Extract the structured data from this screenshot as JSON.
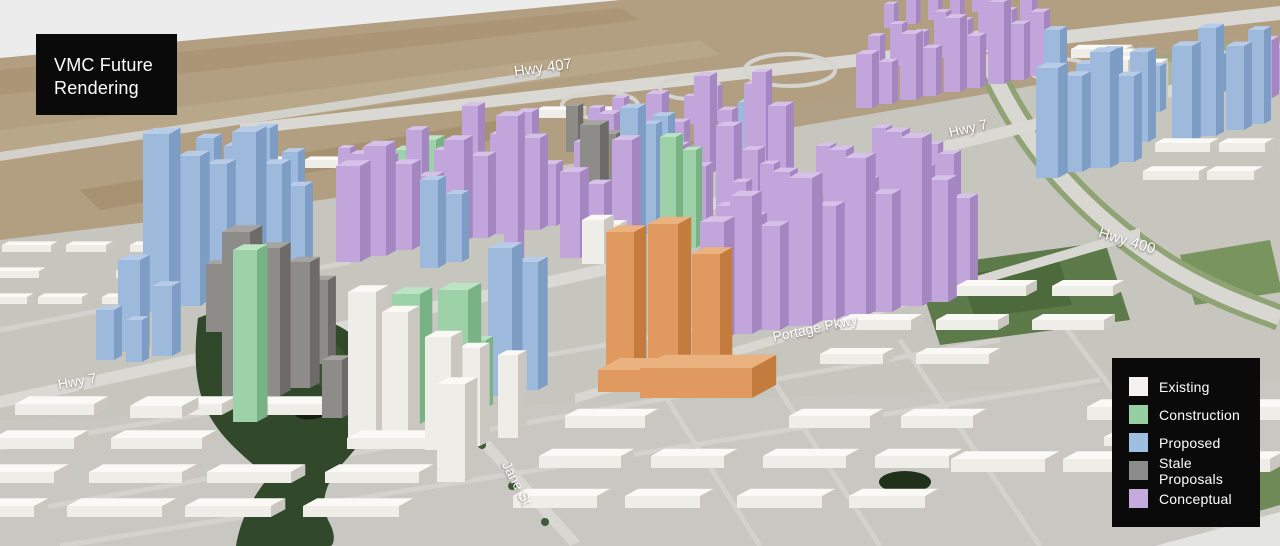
{
  "title": {
    "line1": "VMC Future",
    "line2": "Rendering"
  },
  "legend": {
    "items": [
      {
        "key": "existing",
        "label": "Existing",
        "color": "#f3f2ee"
      },
      {
        "key": "construction",
        "label": "Construction",
        "color": "#96cfa2"
      },
      {
        "key": "proposed",
        "label": "Proposed",
        "color": "#9fbfe0"
      },
      {
        "key": "stale",
        "label": "Stale Proposals",
        "color": "#8c8c8c"
      },
      {
        "key": "conceptual",
        "label": "Conceptual",
        "color": "#c5aade"
      }
    ]
  },
  "map_labels": [
    {
      "id": "hwy-407",
      "text": "Hwy 407",
      "x": 543,
      "y": 68,
      "rot": -8,
      "size": 15
    },
    {
      "id": "hwy-7-east",
      "text": "Hwy 7",
      "x": 968,
      "y": 128,
      "rot": -13,
      "size": 14
    },
    {
      "id": "hwy-400",
      "text": "Hwy 400",
      "x": 1127,
      "y": 241,
      "rot": 17,
      "size": 15
    },
    {
      "id": "portage-pkwy",
      "text": "Portage Pkwy",
      "x": 815,
      "y": 328,
      "rot": -12,
      "size": 14
    },
    {
      "id": "hwy-7-west",
      "text": "Hwy 7",
      "x": 77,
      "y": 381,
      "rot": -10,
      "size": 14
    },
    {
      "id": "jane-st",
      "text": "Jane St",
      "x": 517,
      "y": 483,
      "rot": 62,
      "size": 14
    }
  ],
  "palette": {
    "existing": {
      "face": "#efede8",
      "side": "#c9c7c0",
      "roof": "#faf9f6"
    },
    "construction": {
      "face": "#9dd1a7",
      "side": "#79b385",
      "roof": "#bce3c3"
    },
    "proposed": {
      "face": "#9db9dc",
      "side": "#7d9dc4",
      "roof": "#b8cce8"
    },
    "stale": {
      "face": "#8e8c88",
      "side": "#6d6b67",
      "roof": "#a6a4a0"
    },
    "conceptual": {
      "face": "#c2a5da",
      "side": "#a486c1",
      "roof": "#d6c2e8"
    },
    "orange": {
      "face": "#e09a60",
      "side": "#c47c3e",
      "roof": "#eab27e"
    }
  },
  "scene": {
    "buildings": {
      "conceptual": [
        [
          336,
          262,
          24,
          96
        ],
        [
          364,
          256,
          22,
          110
        ],
        [
          392,
          250,
          20,
          86
        ],
        [
          418,
          246,
          18,
          70
        ],
        [
          444,
          242,
          20,
          102
        ],
        [
          470,
          238,
          18,
          82
        ],
        [
          496,
          234,
          20,
          118
        ],
        [
          522,
          230,
          18,
          92
        ],
        [
          504,
          262,
          14,
          146
        ],
        [
          350,
          212,
          16,
          58
        ],
        [
          378,
          206,
          14,
          50
        ],
        [
          406,
          200,
          16,
          70
        ],
        [
          434,
          196,
          14,
          46
        ],
        [
          462,
          192,
          16,
          86
        ],
        [
          490,
          188,
          14,
          54
        ],
        [
          516,
          184,
          16,
          72
        ],
        [
          540,
          226,
          16,
          62
        ],
        [
          338,
          182,
          12,
          34
        ],
        [
          362,
          176,
          12,
          28
        ],
        [
          560,
          258,
          20,
          86
        ],
        [
          586,
          252,
          18,
          68
        ],
        [
          612,
          248,
          20,
          108
        ],
        [
          664,
          240,
          18,
          94
        ],
        [
          690,
          236,
          16,
          70
        ],
        [
          716,
          232,
          18,
          106
        ],
        [
          742,
          228,
          16,
          78
        ],
        [
          768,
          224,
          18,
          118
        ],
        [
          574,
          196,
          14,
          54
        ],
        [
          598,
          190,
          16,
          76
        ],
        [
          646,
          182,
          16,
          88
        ],
        [
          670,
          178,
          14,
          56
        ],
        [
          694,
          174,
          16,
          98
        ],
        [
          718,
          170,
          14,
          60
        ],
        [
          744,
          166,
          14,
          82
        ],
        [
          766,
          162,
          12,
          46
        ],
        [
          588,
          140,
          12,
          32
        ],
        [
          612,
          136,
          12,
          38
        ],
        [
          636,
          132,
          10,
          26
        ],
        [
          684,
          124,
          10,
          28
        ],
        [
          708,
          120,
          10,
          34
        ],
        [
          752,
          204,
          14,
          132
        ],
        [
          700,
          340,
          24,
          118
        ],
        [
          730,
          334,
          22,
          138
        ],
        [
          760,
          330,
          20,
          104
        ],
        [
          788,
          326,
          24,
          148
        ],
        [
          816,
          320,
          20,
          114
        ],
        [
          844,
          316,
          22,
          158
        ],
        [
          872,
          312,
          20,
          118
        ],
        [
          900,
          306,
          22,
          168
        ],
        [
          928,
          302,
          20,
          122
        ],
        [
          952,
          296,
          18,
          98
        ],
        [
          716,
          290,
          18,
          84
        ],
        [
          744,
          284,
          16,
          68
        ],
        [
          772,
          280,
          18,
          108
        ],
        [
          800,
          276,
          16,
          78
        ],
        [
          828,
          272,
          18,
          122
        ],
        [
          856,
          268,
          16,
          88
        ],
        [
          884,
          264,
          18,
          132
        ],
        [
          912,
          260,
          16,
          92
        ],
        [
          938,
          256,
          16,
          102
        ],
        [
          732,
          240,
          14,
          58
        ],
        [
          760,
          236,
          14,
          72
        ],
        [
          788,
          232,
          14,
          54
        ],
        [
          816,
          228,
          14,
          82
        ],
        [
          844,
          224,
          12,
          58
        ],
        [
          872,
          220,
          14,
          92
        ],
        [
          900,
          216,
          12,
          62
        ],
        [
          926,
          212,
          12,
          68
        ],
        [
          856,
          108,
          16,
          54
        ],
        [
          878,
          104,
          14,
          42
        ],
        [
          900,
          100,
          16,
          66
        ],
        [
          922,
          96,
          14,
          48
        ],
        [
          944,
          92,
          16,
          74
        ],
        [
          966,
          88,
          14,
          52
        ],
        [
          988,
          84,
          16,
          82
        ],
        [
          1010,
          80,
          14,
          56
        ],
        [
          1030,
          76,
          14,
          64
        ],
        [
          868,
          70,
          12,
          34
        ],
        [
          890,
          66,
          12,
          42
        ],
        [
          912,
          62,
          12,
          30
        ],
        [
          934,
          58,
          12,
          46
        ],
        [
          956,
          54,
          12,
          34
        ],
        [
          978,
          50,
          12,
          50
        ],
        [
          1000,
          46,
          12,
          36
        ],
        [
          1020,
          42,
          12,
          42
        ],
        [
          884,
          28,
          10,
          24
        ],
        [
          906,
          24,
          10,
          30
        ],
        [
          928,
          20,
          10,
          20
        ],
        [
          950,
          16,
          10,
          26
        ],
        [
          972,
          12,
          10,
          22
        ],
        [
          1256,
          98,
          16,
          58
        ],
        [
          1272,
          90,
          10,
          42
        ]
      ],
      "proposed": [
        [
          196,
          246,
          18,
          108
        ],
        [
          224,
          242,
          16,
          96
        ],
        [
          252,
          240,
          18,
          112
        ],
        [
          282,
          238,
          16,
          86
        ],
        [
          143,
          312,
          26,
          178
        ],
        [
          178,
          306,
          22,
          150
        ],
        [
          207,
          302,
          20,
          138
        ],
        [
          232,
          298,
          24,
          166
        ],
        [
          262,
          292,
          20,
          128
        ],
        [
          287,
          286,
          18,
          100
        ],
        [
          118,
          352,
          22,
          92
        ],
        [
          152,
          356,
          20,
          70
        ],
        [
          96,
          360,
          18,
          50
        ],
        [
          126,
          362,
          16,
          42
        ],
        [
          420,
          268,
          18,
          88
        ],
        [
          446,
          262,
          16,
          68
        ],
        [
          488,
          396,
          24,
          148
        ],
        [
          516,
          390,
          22,
          128
        ],
        [
          620,
          240,
          18,
          132
        ],
        [
          642,
          234,
          14,
          110
        ],
        [
          652,
          186,
          16,
          70
        ],
        [
          738,
          158,
          14,
          56
        ],
        [
          1036,
          178,
          22,
          110
        ],
        [
          1062,
          172,
          20,
          96
        ],
        [
          1090,
          168,
          20,
          116
        ],
        [
          1116,
          162,
          18,
          86
        ],
        [
          1076,
          122,
          16,
          58
        ],
        [
          1100,
          118,
          16,
          68
        ],
        [
          1130,
          142,
          18,
          90
        ],
        [
          1146,
          112,
          14,
          46
        ],
        [
          1052,
          122,
          14,
          42
        ],
        [
          1044,
          94,
          16,
          64
        ],
        [
          1172,
          142,
          20,
          96
        ],
        [
          1198,
          136,
          18,
          108
        ],
        [
          1226,
          130,
          18,
          84
        ],
        [
          1248,
          124,
          16,
          94
        ],
        [
          1210,
          92,
          14,
          38
        ],
        [
          1240,
          88,
          14,
          34
        ]
      ],
      "construction": [
        [
          233,
          422,
          24,
          172
        ],
        [
          392,
          424,
          28,
          130
        ],
        [
          438,
          416,
          30,
          126
        ],
        [
          470,
          408,
          16,
          68
        ],
        [
          660,
          255,
          16,
          118
        ],
        [
          682,
          248,
          14,
          98
        ],
        [
          372,
          196,
          20,
          30
        ],
        [
          394,
          190,
          18,
          40
        ],
        [
          416,
          186,
          20,
          46
        ],
        [
          438,
          182,
          16,
          30
        ],
        [
          404,
          206,
          22,
          18
        ],
        [
          428,
          202,
          16,
          16
        ],
        [
          452,
          198,
          14,
          22
        ]
      ],
      "stale": [
        [
          222,
          402,
          28,
          170
        ],
        [
          256,
          396,
          24,
          148
        ],
        [
          288,
          388,
          22,
          126
        ],
        [
          310,
          364,
          18,
          84
        ],
        [
          206,
          332,
          16,
          68
        ],
        [
          322,
          418,
          20,
          58
        ],
        [
          580,
          230,
          20,
          105
        ],
        [
          600,
          222,
          16,
          88
        ],
        [
          566,
          152,
          12,
          46
        ]
      ],
      "existing": [
        [
          348,
          440,
          28,
          148
        ],
        [
          382,
          445,
          26,
          133
        ],
        [
          425,
          450,
          26,
          113
        ],
        [
          458,
          446,
          22,
          98
        ],
        [
          498,
          438,
          20,
          83
        ],
        [
          437,
          482,
          28,
          98
        ],
        [
          582,
          264,
          22,
          44
        ],
        [
          604,
          260,
          16,
          36
        ],
        [
          1092,
          118,
          18,
          58
        ],
        [
          1112,
          114,
          16,
          54
        ],
        [
          1132,
          110,
          16,
          50
        ],
        [
          1148,
          106,
          14,
          44
        ],
        [
          1120,
          86,
          14,
          34
        ],
        [
          1100,
          82,
          12,
          28
        ],
        [
          130,
          418,
          52,
          12,
          30
        ]
      ],
      "orange": [
        [
          606,
          378,
          28,
          146
        ],
        [
          648,
          374,
          30,
          150
        ],
        [
          692,
          370,
          28,
          116
        ],
        [
          598,
          392,
          58,
          22,
          40
        ],
        [
          640,
          398,
          112,
          30,
          44
        ]
      ]
    },
    "warehouse_regions": [
      {
        "x0": 15,
        "y0": 415,
        "rows": 4,
        "cols": 4,
        "dx": 118,
        "dy": 34,
        "rowShiftX": -22,
        "w": 88,
        "h": 11,
        "d": 26
      },
      {
        "x0": 565,
        "y0": 428,
        "rows": 3,
        "cols": 4,
        "dx": 112,
        "dy": 40,
        "rowShiftX": -26,
        "w": 78,
        "h": 12,
        "d": 24
      },
      {
        "x0": 860,
        "y0": 296,
        "rows": 3,
        "cols": 3,
        "dx": 96,
        "dy": 34,
        "rowShiftX": -20,
        "w": 66,
        "h": 10,
        "d": 20
      },
      {
        "x0": 2,
        "y0": 252,
        "rows": 3,
        "cols": 4,
        "dx": 64,
        "dy": 26,
        "rowShiftX": -14,
        "w": 44,
        "h": 7,
        "d": 12
      },
      {
        "x0": 975,
        "y0": 420,
        "rows": 2,
        "cols": 3,
        "dx": 112,
        "dy": 52,
        "rowShiftX": -24,
        "w": 86,
        "h": 13,
        "d": 26
      },
      {
        "x0": 240,
        "y0": 168,
        "rows": 1,
        "cols": 3,
        "dx": 64,
        "dy": 0,
        "rowShiftX": 0,
        "w": 42,
        "h": 8,
        "d": 12
      },
      {
        "x0": 536,
        "y0": 118,
        "rows": 1,
        "cols": 2,
        "dx": 62,
        "dy": -8,
        "rowShiftX": 0,
        "w": 44,
        "h": 8,
        "d": 12
      },
      {
        "x0": 1005,
        "y0": 58,
        "rows": 1,
        "cols": 2,
        "dx": 66,
        "dy": -6,
        "rowShiftX": 0,
        "w": 52,
        "h": 9,
        "d": 14
      },
      {
        "x0": 1155,
        "y0": 152,
        "rows": 2,
        "cols": 2,
        "dx": 64,
        "dy": 28,
        "rowShiftX": -12,
        "w": 52,
        "h": 9,
        "d": 16
      },
      {
        "x0": 1120,
        "y0": 400,
        "rows": 2,
        "cols": 2,
        "dx": 70,
        "dy": 46,
        "rowShiftX": -16,
        "w": 56,
        "h": 9,
        "d": 16
      }
    ]
  }
}
